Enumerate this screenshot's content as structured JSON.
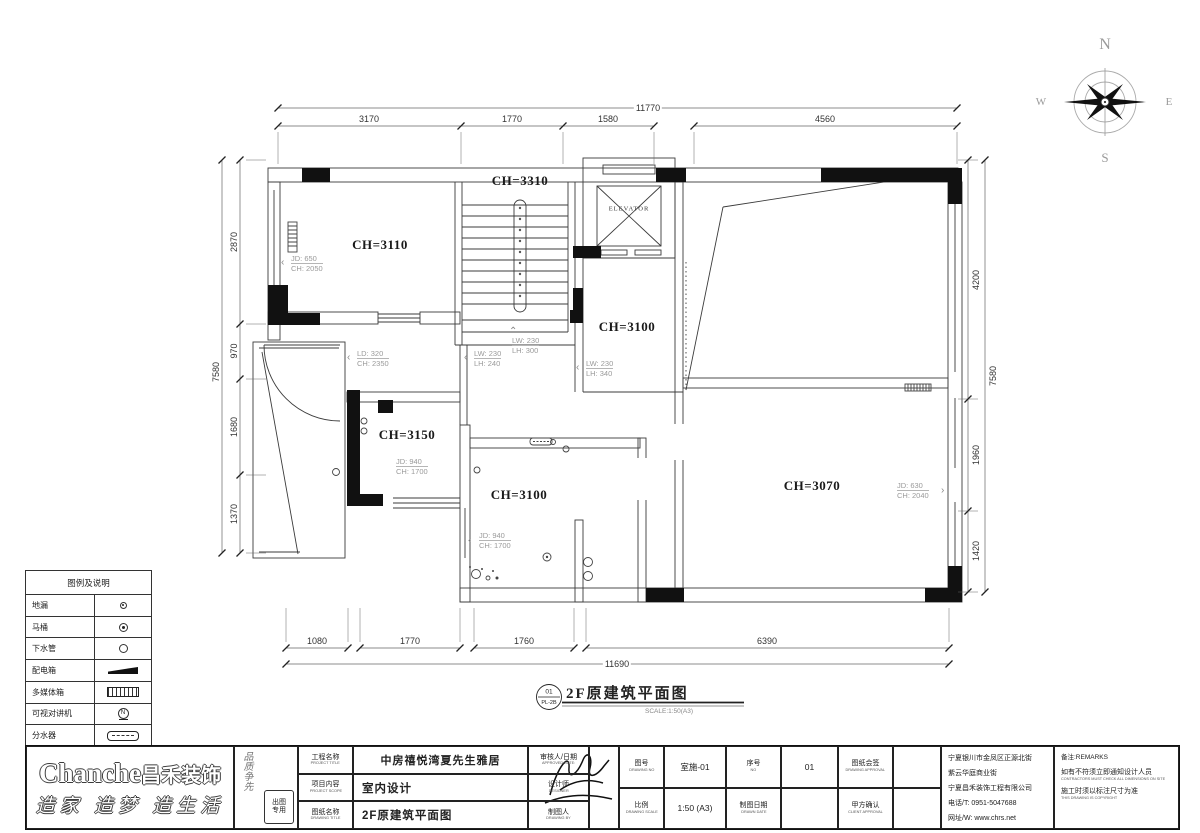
{
  "icons": {
    "left_arrow": "‹",
    "right_arrow": "›",
    "up_arrow": "⌃"
  },
  "compass": {
    "n": "N",
    "s": "S",
    "e": "E",
    "w": "W"
  },
  "dims": {
    "top_total": "11770",
    "top_segments": [
      "3170",
      "1770",
      "1580",
      "4560"
    ],
    "bottom_total": "11690",
    "bottom_segments": [
      "1080",
      "1770",
      "1760",
      "6390"
    ],
    "left_total": "7580",
    "left_segments": [
      "2870",
      "970",
      "1680",
      "1370"
    ],
    "right_total": "7580",
    "right_segments": [
      "4200",
      "1960",
      "1420"
    ]
  },
  "rooms": [
    "CH=3110",
    "CH=3310",
    "CH=3100",
    "CH=3150",
    "CH=3100",
    "CH=3070"
  ],
  "elevator_label": "ELEVATOR",
  "annotations": [
    {
      "l1": "JD: 650",
      "l2": "CH: 2050"
    },
    {
      "l1": "LD: 320",
      "l2": "CH: 2350"
    },
    {
      "l1": "LW: 230",
      "l2": "LH: 240"
    },
    {
      "l1": "LW: 230",
      "l2": "LH: 300"
    },
    {
      "l1": "LW: 230",
      "l2": "LH: 340"
    },
    {
      "l1": "JD: 940",
      "l2": "CH: 1700"
    },
    {
      "l1": "JD: 940",
      "l2": "CH: 1700"
    },
    {
      "l1": "JD: 630",
      "l2": "CH: 2040"
    }
  ],
  "drawing_mark": {
    "num": "01",
    "code": "PL-2B",
    "title": "2F原建筑平面图",
    "scale": "SCALE:1:50(A3)"
  },
  "legend": {
    "title": "图例及说明",
    "rows": [
      "地漏",
      "马桶",
      "下水管",
      "配电箱",
      "多媒体箱",
      "可视对讲机",
      "分水器"
    ]
  },
  "logo": {
    "brand_en": "Chanche",
    "brand_cn": "昌禾装饰",
    "slogan": "造家 造梦 造生活",
    "motto": "品质争先",
    "stamp": "出图专用"
  },
  "titleblock": {
    "sec1": [
      {
        "label": "工程名称",
        "sub": "PROJECT TITLE",
        "value": "中房禧悦湾夏先生雅居"
      },
      {
        "label": "项目内容",
        "sub": "PROJECT SCOPE",
        "value": "室内设计"
      },
      {
        "label": "图纸名称",
        "sub": "DRAWING TITLE",
        "value": "2F原建筑平面图"
      }
    ],
    "sec2": [
      {
        "label": "审核人/日期",
        "sub": "APPROVED/DATE:"
      },
      {
        "label": "设计师",
        "sub": "DESIGNER"
      },
      {
        "label": "制图人",
        "sub": "DRAWING BY"
      }
    ],
    "sec3": {
      "r1": [
        {
          "l": "图号",
          "s": "DRAWING NO"
        },
        {
          "v": "室施-01"
        },
        {
          "l": "序号",
          "s": "NO"
        },
        {
          "v": "01"
        },
        {
          "l": "图纸会签",
          "s": "DRAWING APPROVAL"
        }
      ],
      "r2": [
        {
          "l": "比例",
          "s": "DRAWING SCALE"
        },
        {
          "v": "1:50 (A3)"
        },
        {
          "l": "制图日期",
          "s": "DRAWN DATE"
        },
        {
          "l": "甲方确认",
          "s": "CLIENT APPROVAL"
        }
      ]
    },
    "company": [
      "宁夏银川市金凤区正源北街",
      "紫云华庭商业街",
      "宁夏昌禾装饰工程有限公司",
      "电话/T: 0951-5047688",
      "网址/W: www.chrs.net"
    ],
    "remarks": {
      "title": "备注:REMARKS",
      "l1": "如有不符须立即通知设计人员",
      "l2": "CONTRACTORS MUST CHECK ALL DIMENSIONS ON SITE",
      "l3": "施工时须以标注尺寸为准",
      "l4": "THIS DRAWING IS COPYRIGHT"
    }
  }
}
